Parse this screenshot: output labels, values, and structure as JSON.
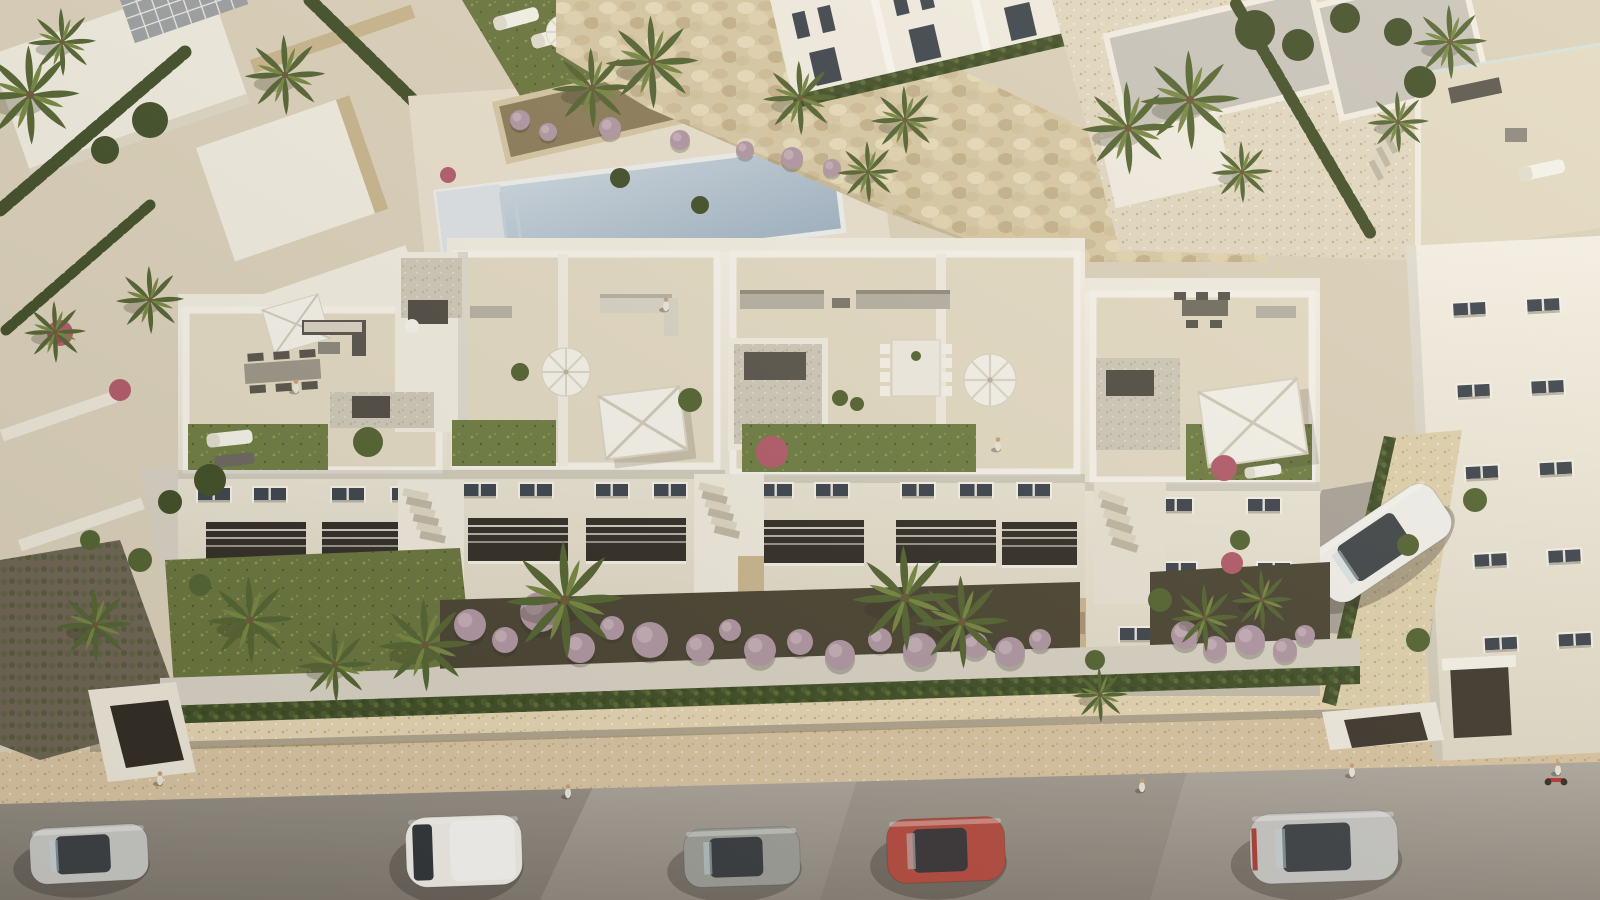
{
  "meta": {
    "scene_type": "aerial architectural 3d render",
    "subject": "white mediterranean apartment complex with rooftop terraces, private gardens, community pool and street parking",
    "time_of_day": "late afternoon sun from the right"
  },
  "palette": {
    "ground_beige": "#dcd2bd",
    "road_gray": "#a49e94",
    "road_gray_dark": "#8f8980",
    "sidewalk_beige": "#d9c5a3",
    "wall_coping": "#e6d6b4",
    "building_white": "#f2eee3",
    "building_shadow": "#e0d9c8",
    "terrace_floor": "#e4dbc6",
    "stone_trim": "#c9b68f",
    "roof_gray": "#c8c4bc",
    "window_glass": "#39414b",
    "window_frame": "#f7f4ec",
    "equipment_dark": "#4e4a42",
    "furniture_dark": "#56524a",
    "furniture_light": "#d9d4c6",
    "furniture_taupe": "#b5b0a4",
    "lawn_green": "#67743c",
    "roof_lawn": "#6d7c42",
    "hedge_dark": "#3e4c26",
    "palm_green": "#516230",
    "palm_light": "#74853f",
    "mulch_dark": "#474131",
    "shrub_purple": "#b096a4",
    "shrub_pink": "#b2586a",
    "pool_blue": "#b7c7d6",
    "pool_steps": "#dde3e8",
    "gravel_gray": "#cfc9ba",
    "path_light": "#d8d3c6",
    "umbrella_white": "#f6f4ed",
    "skin_tone": "#caa07a"
  },
  "scene": {
    "vehicles": [
      {
        "id": "parked-suv-silver",
        "color": "#c9c9c7",
        "x": 30,
        "y": 826,
        "w": 118,
        "h": 56,
        "angle": -3,
        "style": "suv"
      },
      {
        "id": "parked-van-white",
        "color": "#f1efe9",
        "x": 406,
        "y": 816,
        "w": 116,
        "h": 70,
        "angle": -2,
        "style": "van"
      },
      {
        "id": "parked-hatchback-gray",
        "color": "#9c9e99",
        "x": 684,
        "y": 828,
        "w": 116,
        "h": 58,
        "angle": -2,
        "style": "car"
      },
      {
        "id": "parked-car-red",
        "color": "#b5493e",
        "x": 887,
        "y": 818,
        "w": 118,
        "h": 64,
        "angle": -2,
        "style": "car"
      },
      {
        "id": "parked-car-silver",
        "color": "#c7c7c5",
        "x": 1250,
        "y": 812,
        "w": 148,
        "h": 70,
        "angle": -2,
        "style": "car",
        "stripe": "#a83c34"
      },
      {
        "id": "driveway-car-white",
        "color": "#f3f2ee",
        "x": 1308,
        "y": 512,
        "w": 146,
        "h": 62,
        "angle": -34,
        "style": "car"
      }
    ],
    "palms": [
      [
        30,
        95,
        1.6
      ],
      [
        62,
        42,
        1.1
      ],
      [
        285,
        75,
        1.3
      ],
      [
        150,
        300,
        1.1
      ],
      [
        55,
        332,
        1.0
      ],
      [
        592,
        88,
        1.3
      ],
      [
        652,
        62,
        1.5
      ],
      [
        800,
        98,
        1.2
      ],
      [
        868,
        172,
        1.0
      ],
      [
        905,
        120,
        1.1
      ],
      [
        1128,
        128,
        1.5
      ],
      [
        1190,
        100,
        1.6
      ],
      [
        1242,
        172,
        1.0
      ],
      [
        1450,
        42,
        1.2
      ],
      [
        1398,
        122,
        1.0
      ],
      [
        565,
        600,
        1.9
      ],
      [
        425,
        645,
        1.5
      ],
      [
        250,
        620,
        1.4
      ],
      [
        335,
        665,
        1.2
      ],
      [
        905,
        598,
        1.7
      ],
      [
        962,
        622,
        1.5
      ],
      [
        1205,
        618,
        1.1
      ],
      [
        1262,
        600,
        1.0
      ],
      [
        95,
        625,
        1.2
      ],
      [
        1100,
        695,
        0.9
      ]
    ],
    "purple_shrubs": [
      [
        470,
        625,
        16
      ],
      [
        505,
        640,
        13
      ],
      [
        540,
        612,
        20
      ],
      [
        580,
        648,
        15
      ],
      [
        612,
        628,
        12
      ],
      [
        650,
        640,
        18
      ],
      [
        700,
        648,
        14
      ],
      [
        730,
        630,
        11
      ],
      [
        760,
        650,
        16
      ],
      [
        800,
        642,
        13
      ],
      [
        840,
        655,
        15
      ],
      [
        880,
        640,
        12
      ],
      [
        920,
        650,
        17
      ],
      [
        975,
        645,
        13
      ],
      [
        1010,
        652,
        15
      ],
      [
        1040,
        640,
        11
      ],
      [
        1185,
        635,
        14
      ],
      [
        1215,
        648,
        12
      ],
      [
        1250,
        640,
        15
      ],
      [
        1285,
        650,
        12
      ],
      [
        1305,
        635,
        10
      ],
      [
        520,
        120,
        10
      ],
      [
        548,
        132,
        9
      ],
      [
        610,
        128,
        11
      ],
      [
        680,
        140,
        10
      ],
      [
        745,
        150,
        9
      ],
      [
        792,
        158,
        11
      ],
      [
        832,
        168,
        9
      ]
    ],
    "pink_shrubs": [
      [
        60,
        333,
        13
      ],
      [
        120,
        390,
        11
      ],
      [
        1232,
        563,
        11
      ],
      [
        448,
        175,
        8
      ],
      [
        772,
        452,
        16
      ],
      [
        1224,
        468,
        13
      ]
    ],
    "green_shrubs": [
      [
        368,
        442,
        15
      ],
      [
        690,
        400,
        12
      ],
      [
        840,
        398,
        8
      ],
      [
        857,
        404,
        7
      ],
      [
        520,
        372,
        9
      ],
      [
        1240,
        540,
        10
      ],
      [
        1475,
        500,
        12
      ],
      [
        90,
        540,
        10
      ],
      [
        140,
        560,
        12
      ],
      [
        200,
        585,
        11
      ],
      [
        1160,
        600,
        12
      ],
      [
        1408,
        545,
        11
      ],
      [
        1418,
        640,
        12
      ],
      [
        1095,
        660,
        10
      ]
    ],
    "round_trees": [
      [
        150,
        120,
        18
      ],
      [
        105,
        150,
        14
      ],
      [
        1255,
        30,
        20
      ],
      [
        1298,
        45,
        16
      ],
      [
        1345,
        18,
        15
      ],
      [
        1420,
        82,
        16
      ],
      [
        1398,
        32,
        14
      ],
      [
        210,
        480,
        16
      ],
      [
        170,
        502,
        12
      ],
      [
        620,
        178,
        10
      ],
      [
        700,
        205,
        9
      ]
    ],
    "people": [
      [
        568,
        793
      ],
      [
        1142,
        787
      ],
      [
        1352,
        772
      ],
      [
        160,
        780
      ],
      [
        998,
        446
      ],
      [
        1558,
        770
      ],
      [
        666,
        306
      ],
      [
        296,
        388
      ]
    ]
  }
}
